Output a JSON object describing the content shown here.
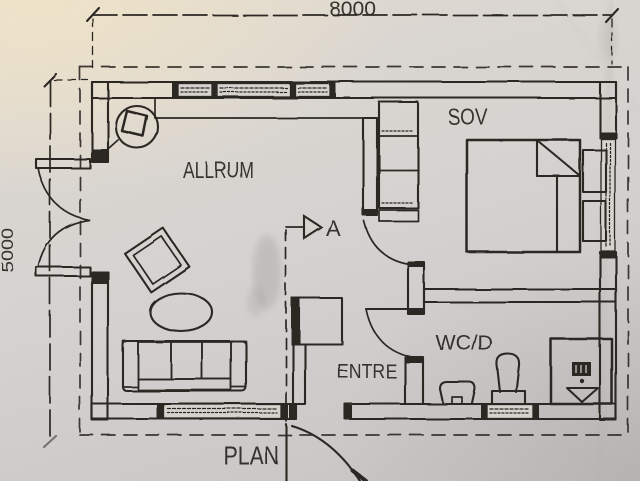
{
  "plan": {
    "drawing_title": "PLAN",
    "section_label": "A",
    "dimensions": {
      "width": "8000",
      "height": "5000"
    },
    "rooms": {
      "living": "ALLRUM",
      "bedroom": "SOV",
      "bathroom": "WC/D",
      "entry": "ENTRE"
    },
    "colors": {
      "ink": "#2b2723",
      "paper": "#d7d4d0"
    }
  }
}
